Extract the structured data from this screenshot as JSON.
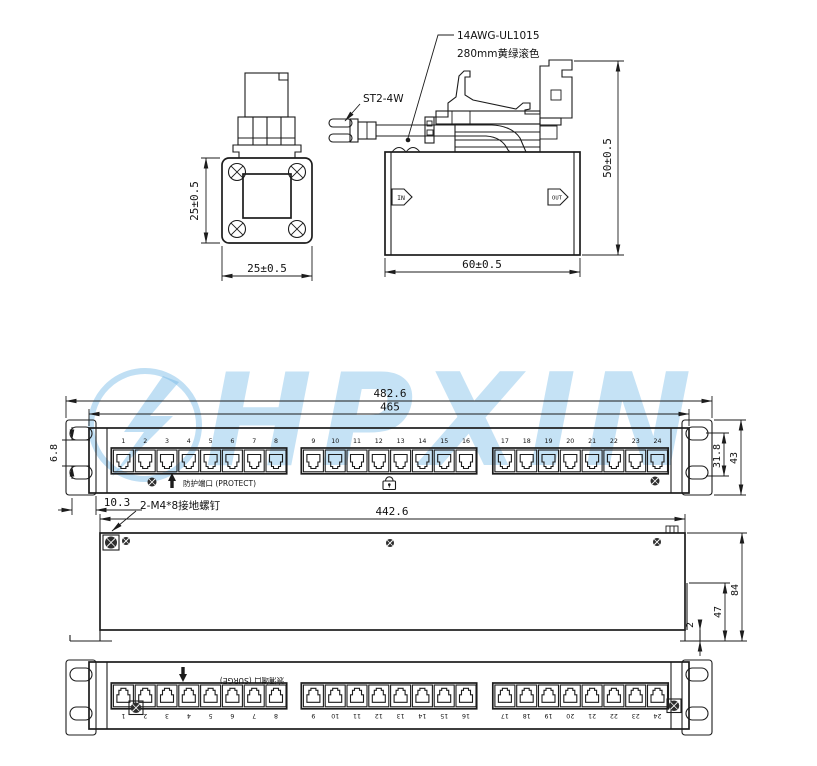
{
  "watermark": {
    "text": "HPXIN",
    "color": "#74b9e6"
  },
  "module_front_view": {
    "dim_height": "25±0.5",
    "dim_width": "25±0.5"
  },
  "module_side_view": {
    "wire_label_line1": "14AWG-UL1015",
    "wire_label_line2": "280mm黄绿滚色",
    "terminal_label": "ST2-4W",
    "in_label": "IN",
    "out_label": "OUT",
    "dim_width": "60±0.5",
    "dim_height": "50±0.5"
  },
  "panel_front_view": {
    "dim_overall_width": "482.6",
    "dim_body_width": "465",
    "dim_ear_hole_gap": "6.8",
    "dim_ear_offset": "10.3",
    "dim_hole_spacing": "31.8",
    "dim_panel_height": "43",
    "protect_label": "防护端口 (PROTECT)"
  },
  "ground_screw_label": "2-M4*8接地螺钉",
  "panel_rear_view": {
    "dim_width": "442.6",
    "dim_depth": "84",
    "dim_flange": "47",
    "dim_lip": "2"
  },
  "panel_bottom_view": {
    "surge_label": "浪涌端口 (SURGE)"
  },
  "port_numbers": [
    "1",
    "2",
    "3",
    "4",
    "5",
    "6",
    "7",
    "8",
    "9",
    "10",
    "11",
    "12",
    "13",
    "14",
    "15",
    "16",
    "17",
    "18",
    "19",
    "20",
    "21",
    "22",
    "23",
    "24"
  ]
}
